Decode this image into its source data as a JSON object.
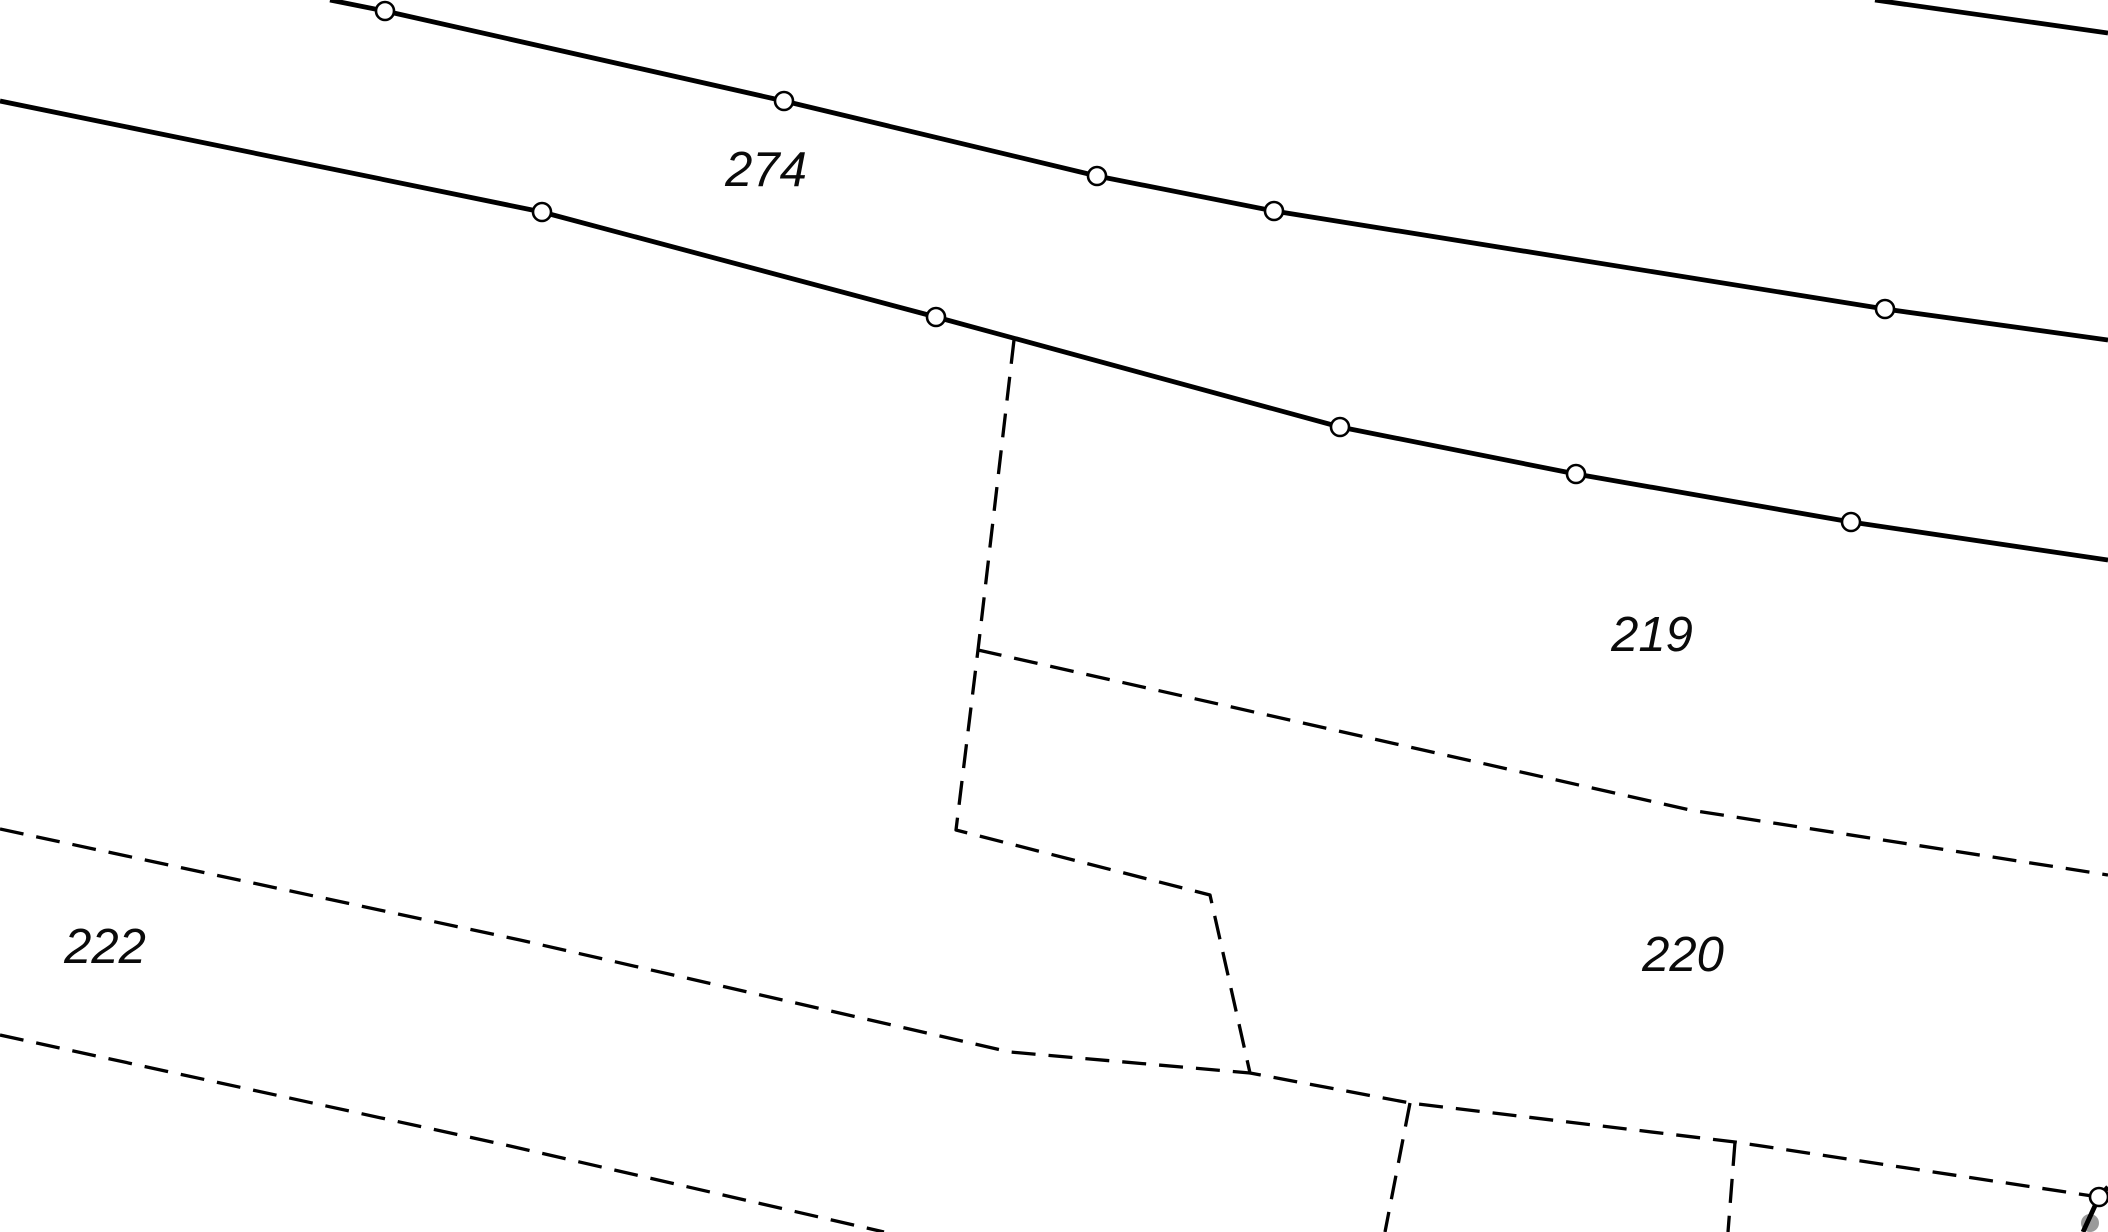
{
  "map": {
    "type": "cadastral-parcel-map",
    "background": "#ffffff",
    "canvas": {
      "width": 2108,
      "height": 1232
    }
  },
  "styles": {
    "solid": {
      "color": "#000000",
      "width": 4.8
    },
    "dashed": {
      "color": "#000000",
      "width": 3.3,
      "dash": "24 13"
    },
    "vertex_marker": {
      "radius": 9,
      "fill": "#ffffff",
      "stroke": "#000000",
      "stroke_width": 2.6
    },
    "survey_dot": {
      "radius": 9,
      "fill": "#9a9a9a"
    }
  },
  "labels": {
    "l274": {
      "text": "274",
      "x": 766,
      "y": 186
    },
    "l219": {
      "text": "219",
      "x": 1652,
      "y": 651
    },
    "l220": {
      "text": "220",
      "x": 1683,
      "y": 971
    },
    "l222": {
      "text": "222",
      "x": 105,
      "y": 963
    }
  },
  "lines": [
    {
      "name": "outer-road-line",
      "style": "solid",
      "points": [
        [
          1875,
          0
        ],
        [
          2108,
          33
        ]
      ],
      "markers": []
    },
    {
      "name": "road-north-edge",
      "style": "solid",
      "points": [
        [
          330,
          0
        ],
        [
          385,
          11
        ],
        [
          784,
          101
        ],
        [
          1097,
          176
        ],
        [
          1274,
          211
        ],
        [
          1885,
          309
        ],
        [
          2108,
          340
        ]
      ],
      "markers": [
        [
          385,
          11
        ],
        [
          784,
          101
        ],
        [
          1097,
          176
        ],
        [
          1274,
          211
        ],
        [
          1885,
          309
        ]
      ]
    },
    {
      "name": "road-south-edge",
      "style": "solid",
      "points": [
        [
          0,
          101
        ],
        [
          542,
          212
        ],
        [
          936,
          317
        ],
        [
          1340,
          427
        ],
        [
          1576,
          474
        ],
        [
          1851,
          522
        ],
        [
          2108,
          560
        ]
      ],
      "markers": [
        [
          542,
          212
        ],
        [
          936,
          317
        ],
        [
          1340,
          427
        ],
        [
          1576,
          474
        ],
        [
          1851,
          522
        ]
      ]
    },
    {
      "name": "southeast-corner-line",
      "style": "solid",
      "points": [
        [
          2083,
          1232
        ],
        [
          2099,
          1197
        ],
        [
          2108,
          1187
        ]
      ],
      "markers": [
        [
          2099,
          1197
        ]
      ]
    },
    {
      "name": "parcel-220-west-south-boundary",
      "style": "dashed",
      "points": [
        [
          1014,
          340
        ],
        [
          978,
          650
        ],
        [
          956,
          830
        ],
        [
          1210,
          895
        ],
        [
          1250,
          1073
        ],
        [
          1410,
          1103
        ],
        [
          1735,
          1142
        ],
        [
          2099,
          1197
        ]
      ],
      "markers": []
    },
    {
      "name": "parcel-219-220-boundary",
      "style": "dashed",
      "points": [
        [
          978,
          650
        ],
        [
          1690,
          810
        ],
        [
          2108,
          875
        ]
      ],
      "markers": []
    },
    {
      "name": "parcel-220-222-boundary",
      "style": "dashed",
      "points": [
        [
          0,
          829
        ],
        [
          520,
          940
        ],
        [
          1010,
          1052
        ],
        [
          1250,
          1073
        ]
      ],
      "markers": []
    },
    {
      "name": "parcel-222-south-boundary",
      "style": "dashed",
      "points": [
        [
          0,
          1035
        ],
        [
          510,
          1146
        ],
        [
          884,
          1232
        ]
      ],
      "markers": []
    },
    {
      "name": "parcel-divider-west",
      "style": "dashed",
      "points": [
        [
          1410,
          1103
        ],
        [
          1385,
          1232
        ]
      ],
      "markers": []
    },
    {
      "name": "parcel-divider-east",
      "style": "dashed",
      "points": [
        [
          1735,
          1142
        ],
        [
          1728,
          1232
        ]
      ],
      "markers": []
    }
  ],
  "survey_dots": [
    {
      "x": 2090,
      "y": 1223
    }
  ]
}
